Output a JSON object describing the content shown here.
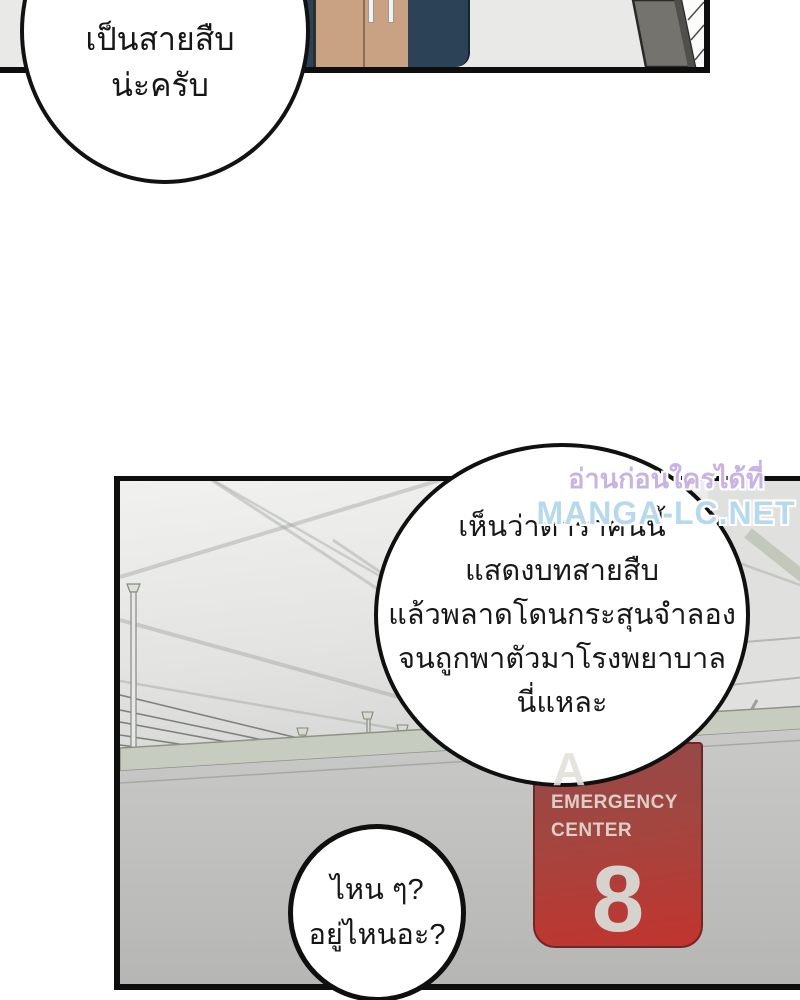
{
  "top_bubble": {
    "lines": [
      "ได้ยินว่าเขา",
      "เป็นสายสืบ",
      "น่ะครับ"
    ]
  },
  "big_bubble": {
    "lines": [
      "เห็นว่าดาราคนนี้",
      "แสดงบทสายสืบ",
      "แล้วพลาดโดนกระสุนจำลอง",
      "จนถูกพาตัวมาโรงพยาบาล",
      "นี่แหละ"
    ]
  },
  "small_bubble": {
    "lines": [
      "ไหน ๆ?",
      "อยู่ไหนอะ?"
    ]
  },
  "sign": {
    "section_letter": "A",
    "title_line1": "EMERGENCY",
    "title_line2": "CENTER",
    "number": "8",
    "color": "#b23a35",
    "text_color": "#dccfc8"
  },
  "watermark": {
    "line1": "อ่านก่อนใครได้ที่",
    "line2": "MANGA-LC.NET",
    "color_line1": "#c8b3e3",
    "color_line2": "#b8d9ec"
  },
  "scene_colors": {
    "panel_border": "#0e0e0e",
    "top_panel_background": "#e9e9e7",
    "jacket_tan": "#c9a183",
    "clothing_navy": "#2c4257",
    "pillar_gray": "#74736d",
    "ceiling_light": "#f0f0ee",
    "ledge_green_gray": "#c7ccc0",
    "wall_gray": "#c2c2c0"
  }
}
